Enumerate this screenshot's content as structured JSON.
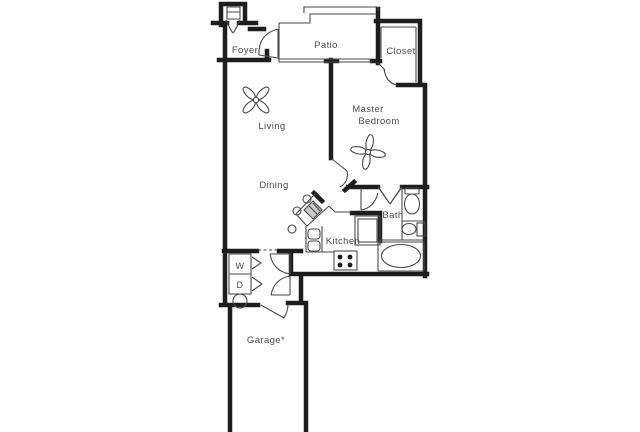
{
  "title": "One-bedroom apartment floor plan with attached garage",
  "colors": {
    "background": "#ffffff",
    "wall": "#1d1d1d",
    "line": "#4a4a4a",
    "text": "#4d4d4d",
    "sink_fill": "#c9c9c9",
    "burner_fill": "#1d1d1d"
  },
  "labels": {
    "foyer": "Foyer",
    "patio": "Patio",
    "closet": "Closet",
    "living": "Living",
    "master_line1": "Master",
    "master_line2": "Bedroom",
    "dining": "Dining",
    "kitchen": "Kitchen",
    "bath": "Bath",
    "washer": "W",
    "dryer": "D",
    "garage": "Garage*"
  },
  "fixtures": {
    "living_fan": "ceiling-fan",
    "bedroom_fan": "ceiling-fan",
    "bath_items": [
      "toilet",
      "pedestal-sink",
      "bathtub",
      "shower"
    ],
    "kitchen_items": [
      "corner-sink",
      "double-basin",
      "stove-4-burner",
      "bar-stools"
    ],
    "utility_items": [
      "washer",
      "dryer",
      "water-heater"
    ]
  }
}
